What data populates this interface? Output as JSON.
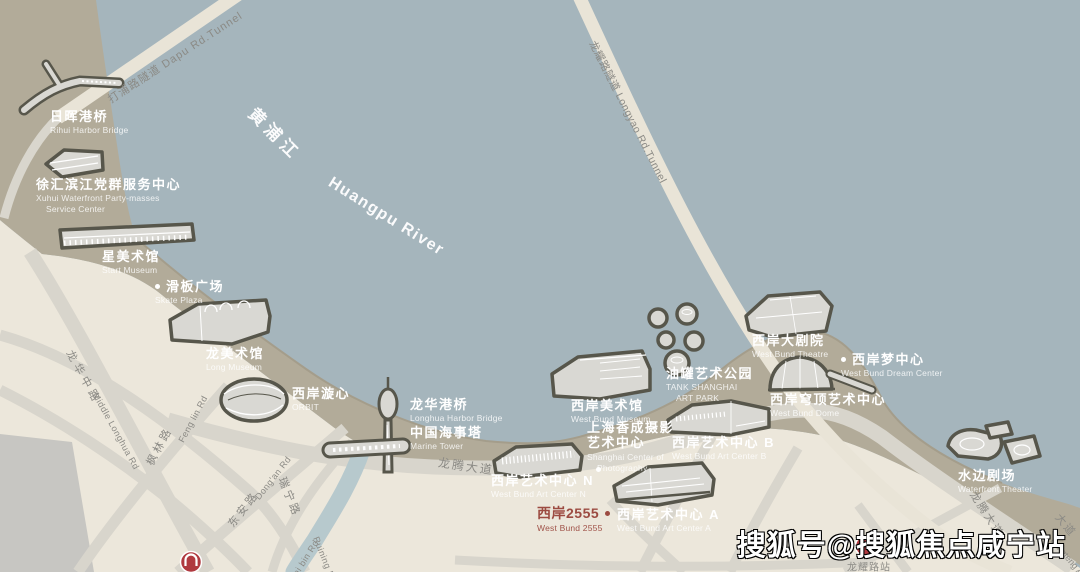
{
  "watermark": {
    "text": "搜狐号@搜狐焦点咸宁站"
  },
  "colors": {
    "river": "#a5b5bc",
    "waterfront_band": "#b2ab99",
    "land": "#ece7db",
    "road": "#d8d5cc",
    "tunnel_road": "#e9e4d7",
    "creek": "#b7c9cd",
    "building_outline": "#57564b",
    "building_fill": "#d9d8d3",
    "road_text": "#8b8a85",
    "highlight_text": "#9c4b41",
    "metro_red": "#b03a40"
  },
  "labels": {
    "landmarks": [
      {
        "id": "rihui-harbor-bridge",
        "zh": "日晖港桥",
        "en": "Rihui Harbor Bridge",
        "x": 50,
        "y": 109
      },
      {
        "id": "xuhui-service-center",
        "zh": "徐汇滨江党群服务中心",
        "en": "Xuhui Waterfront Party-masses",
        "en2": "Service Center",
        "x": 36,
        "y": 177
      },
      {
        "id": "start-museum",
        "zh": "星美术馆",
        "en": "Start Museum",
        "x": 102,
        "y": 249
      },
      {
        "id": "skate-plaza",
        "zh": "滑板广场",
        "en": "Skate Plaza",
        "x": 155,
        "y": 279,
        "dot": "left"
      },
      {
        "id": "long-museum",
        "zh": "龙美术馆",
        "en": "Long Museum",
        "x": 206,
        "y": 346
      },
      {
        "id": "orbit",
        "zh": "西岸漩心",
        "en": "ORBIT",
        "x": 292,
        "y": 386
      },
      {
        "id": "longhua-harbor-bridge",
        "zh": "龙华港桥",
        "en": "Longhua Harbor Bridge",
        "x": 410,
        "y": 397
      },
      {
        "id": "marine-tower",
        "zh": "中国海事塔",
        "en": "Marine Tower",
        "x": 410,
        "y": 425
      },
      {
        "id": "west-bund-museum",
        "zh": "西岸美术馆",
        "en": "West Bund Museum",
        "x": 571,
        "y": 398
      },
      {
        "id": "shanghai-center-of-photography",
        "zh": "上海香成摄影",
        "zh2": "艺术中心",
        "en": "Shanghai Center of",
        "en2": "Photography",
        "x": 587,
        "y": 420,
        "dot_below": [
          9,
          47
        ]
      },
      {
        "id": "tank-art-park",
        "zh": "油罐艺术公园",
        "en": "TANK SHANGHAI",
        "en2": "ART PARK",
        "x": 666,
        "y": 366
      },
      {
        "id": "west-bund-theatre",
        "zh": "西岸大剧院",
        "en": "West Bund Theatre",
        "x": 752,
        "y": 333
      },
      {
        "id": "west-bund-dream-center",
        "zh": "西岸梦中心",
        "en": "West Bund Dream Center",
        "x": 841,
        "y": 352,
        "dot": "left"
      },
      {
        "id": "west-bund-dome",
        "zh": "西岸穹顶艺术中心",
        "en": "West Bund Dome",
        "x": 770,
        "y": 392
      },
      {
        "id": "west-bund-art-center-b",
        "zh": "西岸艺术中心 B",
        "en": "West Bund Art Center B",
        "x": 672,
        "y": 435
      },
      {
        "id": "west-bund-art-center-n",
        "zh": "西岸艺术中心 N",
        "en": "West Bund Art Center N",
        "x": 491,
        "y": 473
      },
      {
        "id": "west-bund-2555",
        "zh": "西岸2555",
        "en": "West Bund 2555",
        "x": 537,
        "y": 505,
        "dot": "right",
        "red": true
      },
      {
        "id": "west-bund-art-center-a",
        "zh": "西岸艺术中心 A",
        "en": "West Bund Art Center A",
        "x": 617,
        "y": 507
      },
      {
        "id": "waterfront-theater",
        "zh": "水边剧场",
        "en": "Waterfront Theater",
        "x": 958,
        "y": 468
      }
    ],
    "roads": [
      {
        "id": "dapu-rd-tunnel",
        "text": "打浦路隧道  Dapu Rd.Tunnel",
        "x": 175,
        "y": 57,
        "rotate": -33,
        "size": 11,
        "ls": 1
      },
      {
        "id": "longyao-rd-tunnel",
        "text": "龙耀路隧道 Longyao Rd.Tunnel",
        "x": 628,
        "y": 112,
        "rotate": 63,
        "size": 10.5,
        "ls": 0.5
      },
      {
        "id": "longteng-ave",
        "text": "龙腾大道",
        "x": 466,
        "y": 466,
        "rotate": 8,
        "size": 12,
        "ls": 2
      },
      {
        "id": "longteng-ave-south",
        "text": "龙腾大道",
        "x": 987,
        "y": 514,
        "rotate": 57,
        "size": 11,
        "ls": 2
      },
      {
        "id": "longteng-ave-corner",
        "text": "大道",
        "x": 1066,
        "y": 525,
        "rotate": 50,
        "size": 11,
        "ls": 2
      },
      {
        "id": "longteng-ave-corner-en",
        "text": "Longteng Ave",
        "x": 1070,
        "y": 560,
        "rotate": 50,
        "size": 9,
        "ls": 0
      },
      {
        "id": "middle-longhua-rd",
        "text": "龙华中路",
        "x": 84,
        "y": 377,
        "rotate": 61,
        "size": 11,
        "ls": 4
      },
      {
        "id": "middle-longhua-rd-en",
        "text": "Middle Longhua Rd",
        "x": 116,
        "y": 431,
        "rotate": 61,
        "size": 9,
        "ls": 0.5
      },
      {
        "id": "fenglin-rd",
        "text": "枫林路",
        "x": 159,
        "y": 446,
        "rotate": -62,
        "size": 11,
        "ls": 3
      },
      {
        "id": "fenglin-rd-en",
        "text": "Feng lin Rd",
        "x": 193,
        "y": 419,
        "rotate": -62,
        "size": 9,
        "ls": 0.5
      },
      {
        "id": "dongan-rd",
        "text": "东安路",
        "x": 243,
        "y": 509,
        "rotate": -52,
        "size": 11,
        "ls": 3
      },
      {
        "id": "dongan-rd-en",
        "text": "Dong'an Rd",
        "x": 273,
        "y": 478,
        "rotate": -52,
        "size": 9,
        "ls": 0.5
      },
      {
        "id": "ruining-rd",
        "text": "瑞宁路",
        "x": 290,
        "y": 497,
        "rotate": 68,
        "size": 11,
        "ls": 3
      },
      {
        "id": "ruining-rd-en",
        "text": "Ruining Rd",
        "x": 325,
        "y": 560,
        "rotate": 68,
        "size": 9,
        "ls": 0.5
      },
      {
        "id": "taibin-rd-en",
        "text": "tai bin Rd",
        "x": 305,
        "y": 559,
        "rotate": -58,
        "size": 9,
        "ls": 0.5
      },
      {
        "id": "longyao-station-label",
        "text": "龙耀路站",
        "x": 869,
        "y": 566,
        "rotate": 0,
        "size": 10,
        "ls": 1
      }
    ],
    "river": [
      {
        "id": "huangpu-river-zh",
        "text": "黄浦江",
        "x": 276,
        "y": 133,
        "rotate": 45,
        "size": 17,
        "ls": 5
      },
      {
        "id": "huangpu-river-en",
        "text": "Huangpu River",
        "x": 386,
        "y": 217,
        "rotate": 32,
        "size": 16,
        "ls": 1.5
      }
    ]
  }
}
